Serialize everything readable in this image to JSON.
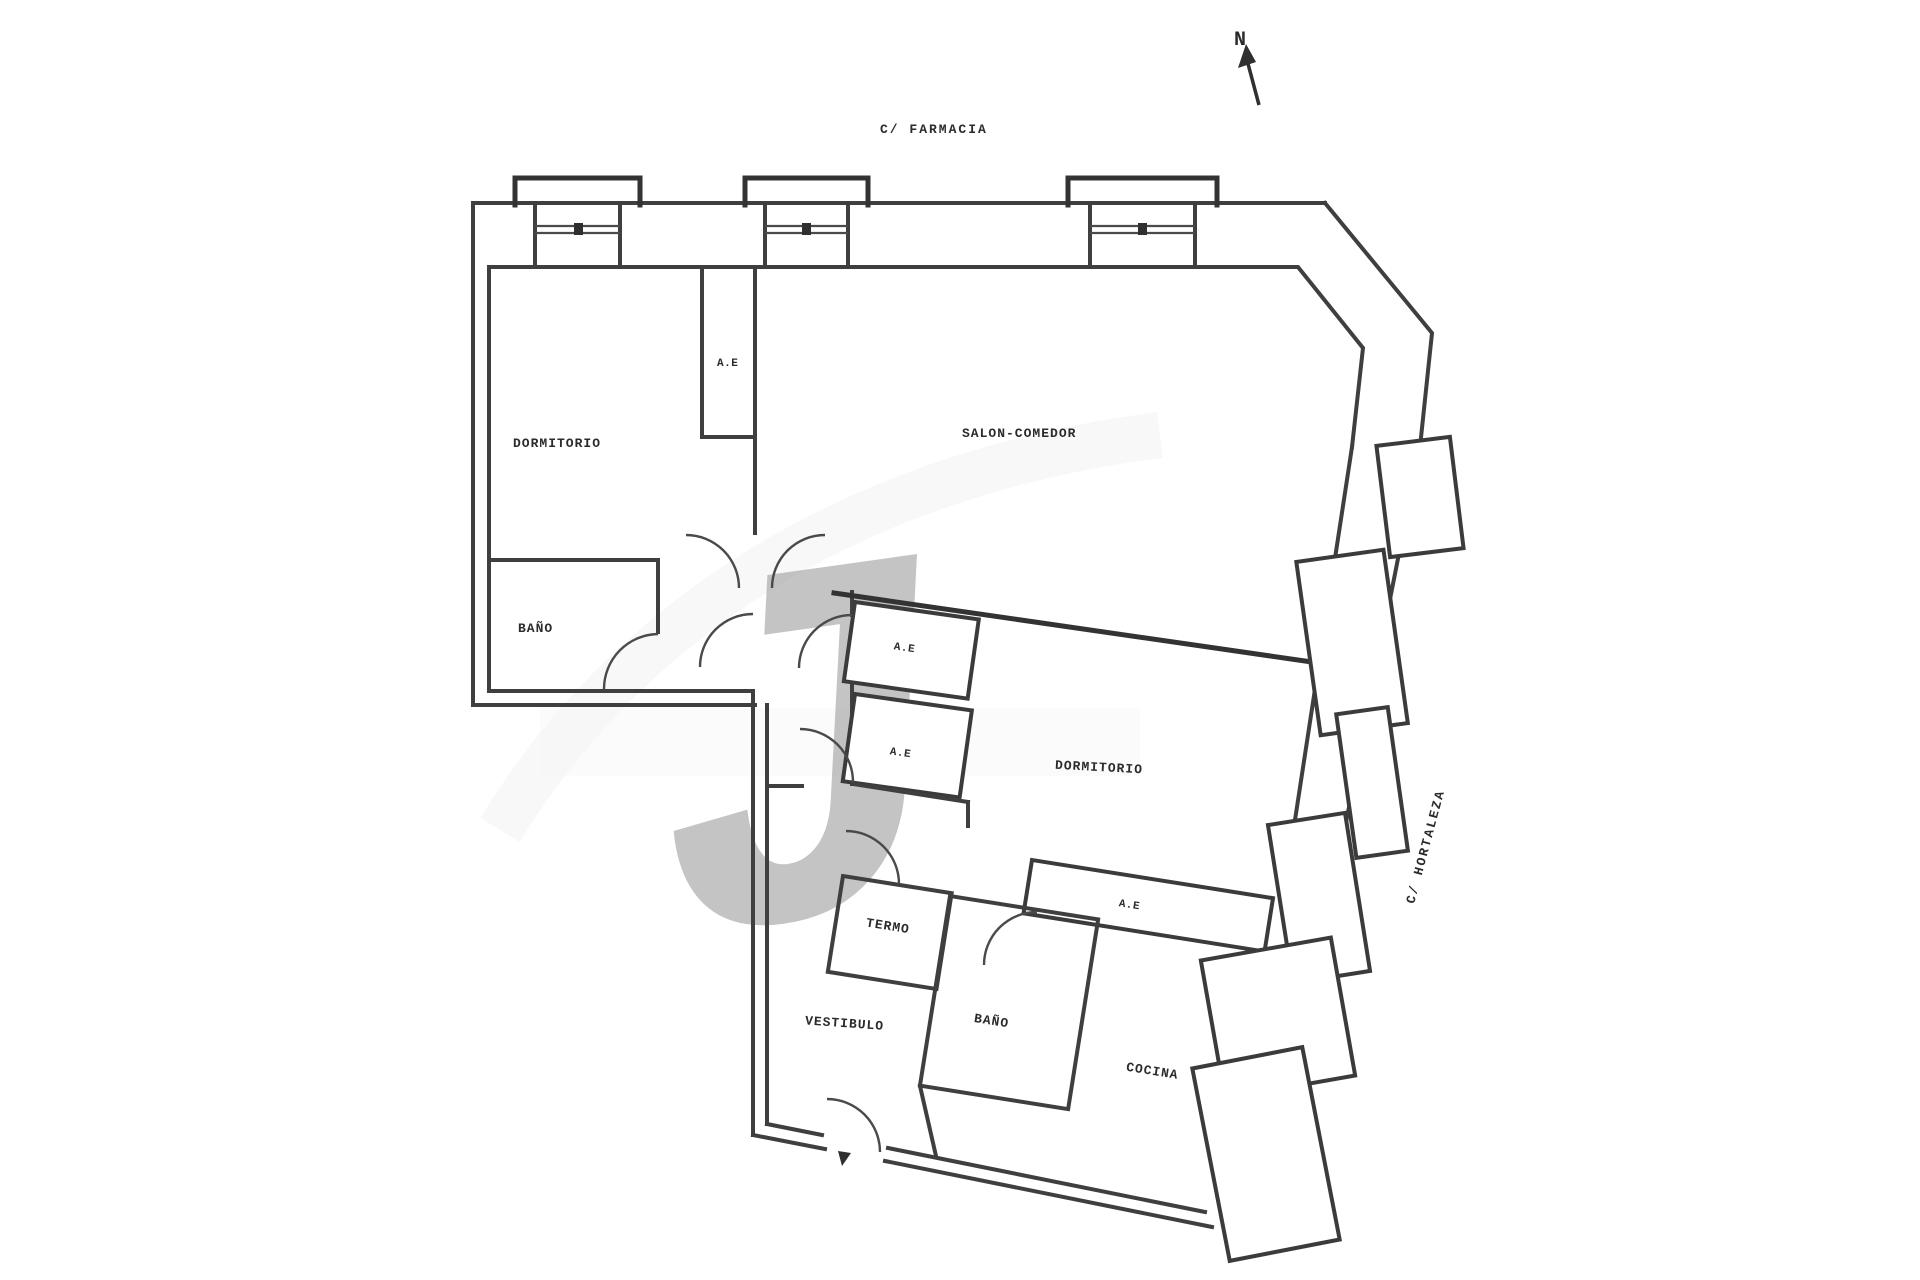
{
  "plan": {
    "streets": {
      "top": "C/ FARMACIA",
      "right": "C/ HORTALEZA"
    },
    "compass": {
      "label": "N"
    },
    "rooms": {
      "dormitorio1": "DORMITORIO",
      "bano1": "BAÑO",
      "salon": "SALON-COMEDOR",
      "dormitorio2": "DORMITORIO",
      "termo": "TERMO",
      "vestibulo": "VESTIBULO",
      "bano2": "BAÑO",
      "cocina": "COCINA",
      "closet": "A.E"
    },
    "colors": {
      "wall": "#3f3f3f",
      "door_arc": "#4a4a4a",
      "label_text": "#2b2b2b",
      "watermark": "#e3e3e3",
      "background": "#ffffff"
    }
  }
}
